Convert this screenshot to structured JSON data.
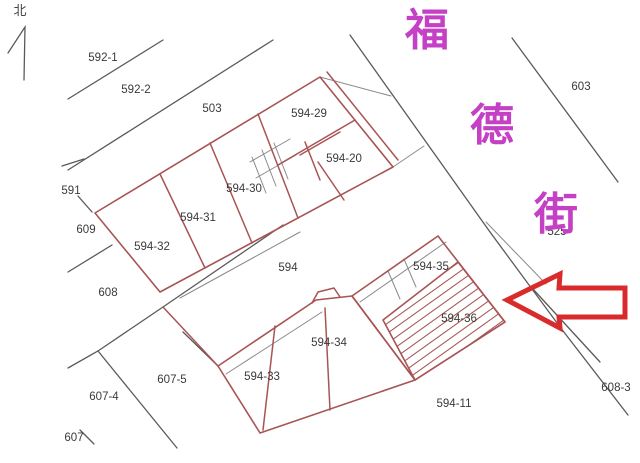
{
  "colors": {
    "parcel-red": "#a85454",
    "line-dark": "#5a5a5a",
    "line-gray": "#8a8a8a",
    "label-dark": "#3a3a3a",
    "street-magenta": "#c440c4",
    "arrow-red": "#d92b2b"
  },
  "north": {
    "label": "北"
  },
  "street": {
    "name": "福德街",
    "chars": [
      "福",
      "德",
      "街"
    ]
  },
  "labels": [
    {
      "id": "592-1",
      "text": "592-1"
    },
    {
      "id": "592-2",
      "text": "592-2"
    },
    {
      "id": "503",
      "text": "503"
    },
    {
      "id": "603",
      "text": "603"
    },
    {
      "id": "594-29",
      "text": "594-29"
    },
    {
      "id": "594-20",
      "text": "594-20"
    },
    {
      "id": "594-30",
      "text": "594-30"
    },
    {
      "id": "594-31",
      "text": "594-31"
    },
    {
      "id": "594-32",
      "text": "594-32"
    },
    {
      "id": "591",
      "text": "591"
    },
    {
      "id": "609",
      "text": "609"
    },
    {
      "id": "608",
      "text": "608"
    },
    {
      "id": "594",
      "text": "594"
    },
    {
      "id": "594-35",
      "text": "594-35"
    },
    {
      "id": "594-36",
      "text": "594-36"
    },
    {
      "id": "594-34",
      "text": "594-34"
    },
    {
      "id": "594-33",
      "text": "594-33"
    },
    {
      "id": "607-5",
      "text": "607-5"
    },
    {
      "id": "607-4",
      "text": "607-4"
    },
    {
      "id": "607",
      "text": "607"
    },
    {
      "id": "594-11",
      "text": "594-11"
    },
    {
      "id": "608-3",
      "text": "608-3"
    },
    {
      "id": "525",
      "text": "525"
    }
  ]
}
